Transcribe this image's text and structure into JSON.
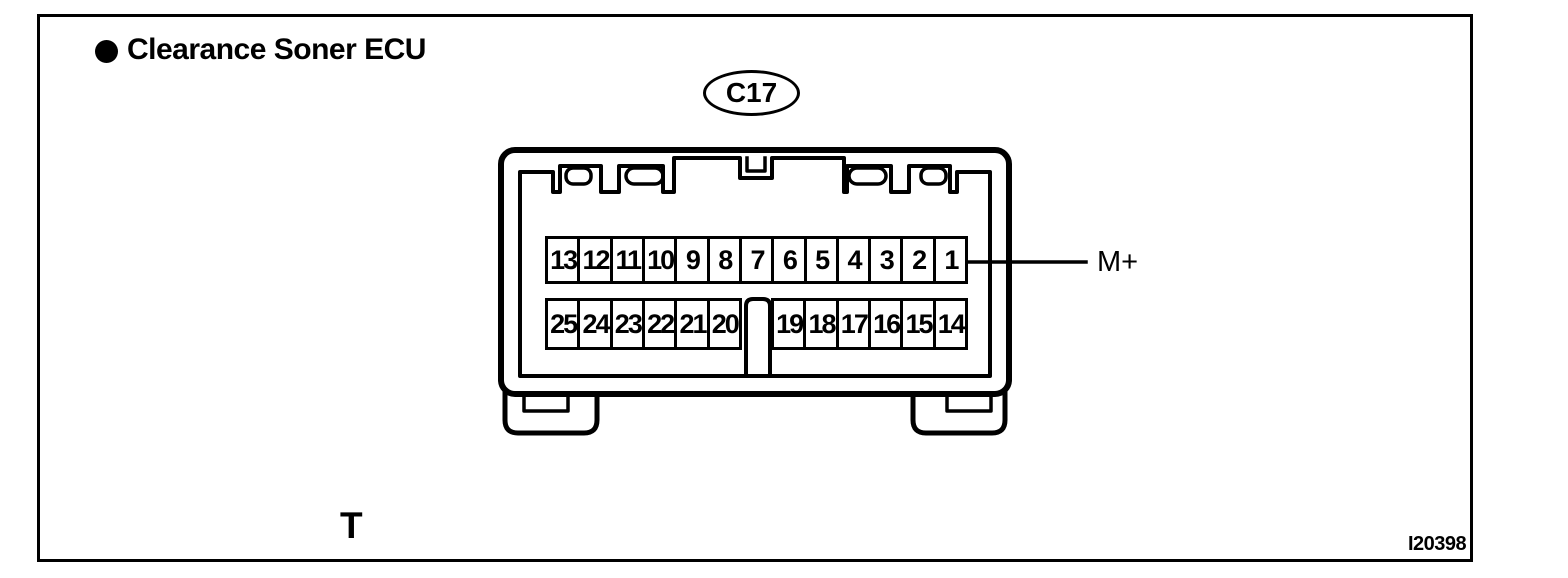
{
  "figure": {
    "title": "Clearance Soner ECU",
    "connector_id": "C17",
    "terminal_label": "M+",
    "footer_left_label": "T",
    "figure_code": "I20398"
  },
  "connector": {
    "pin_rows": {
      "top": [
        "13",
        "12",
        "11",
        "10",
        "9",
        "8",
        "7",
        "6",
        "5",
        "4",
        "3",
        "2",
        "1"
      ],
      "bottom_left": [
        "25",
        "24",
        "23",
        "22",
        "21",
        "20"
      ],
      "bottom_right": [
        "19",
        "18",
        "17",
        "16",
        "15",
        "14"
      ]
    },
    "leader_from_pin": "1"
  },
  "colors": {
    "ink": "#000000",
    "paper": "#ffffff"
  }
}
